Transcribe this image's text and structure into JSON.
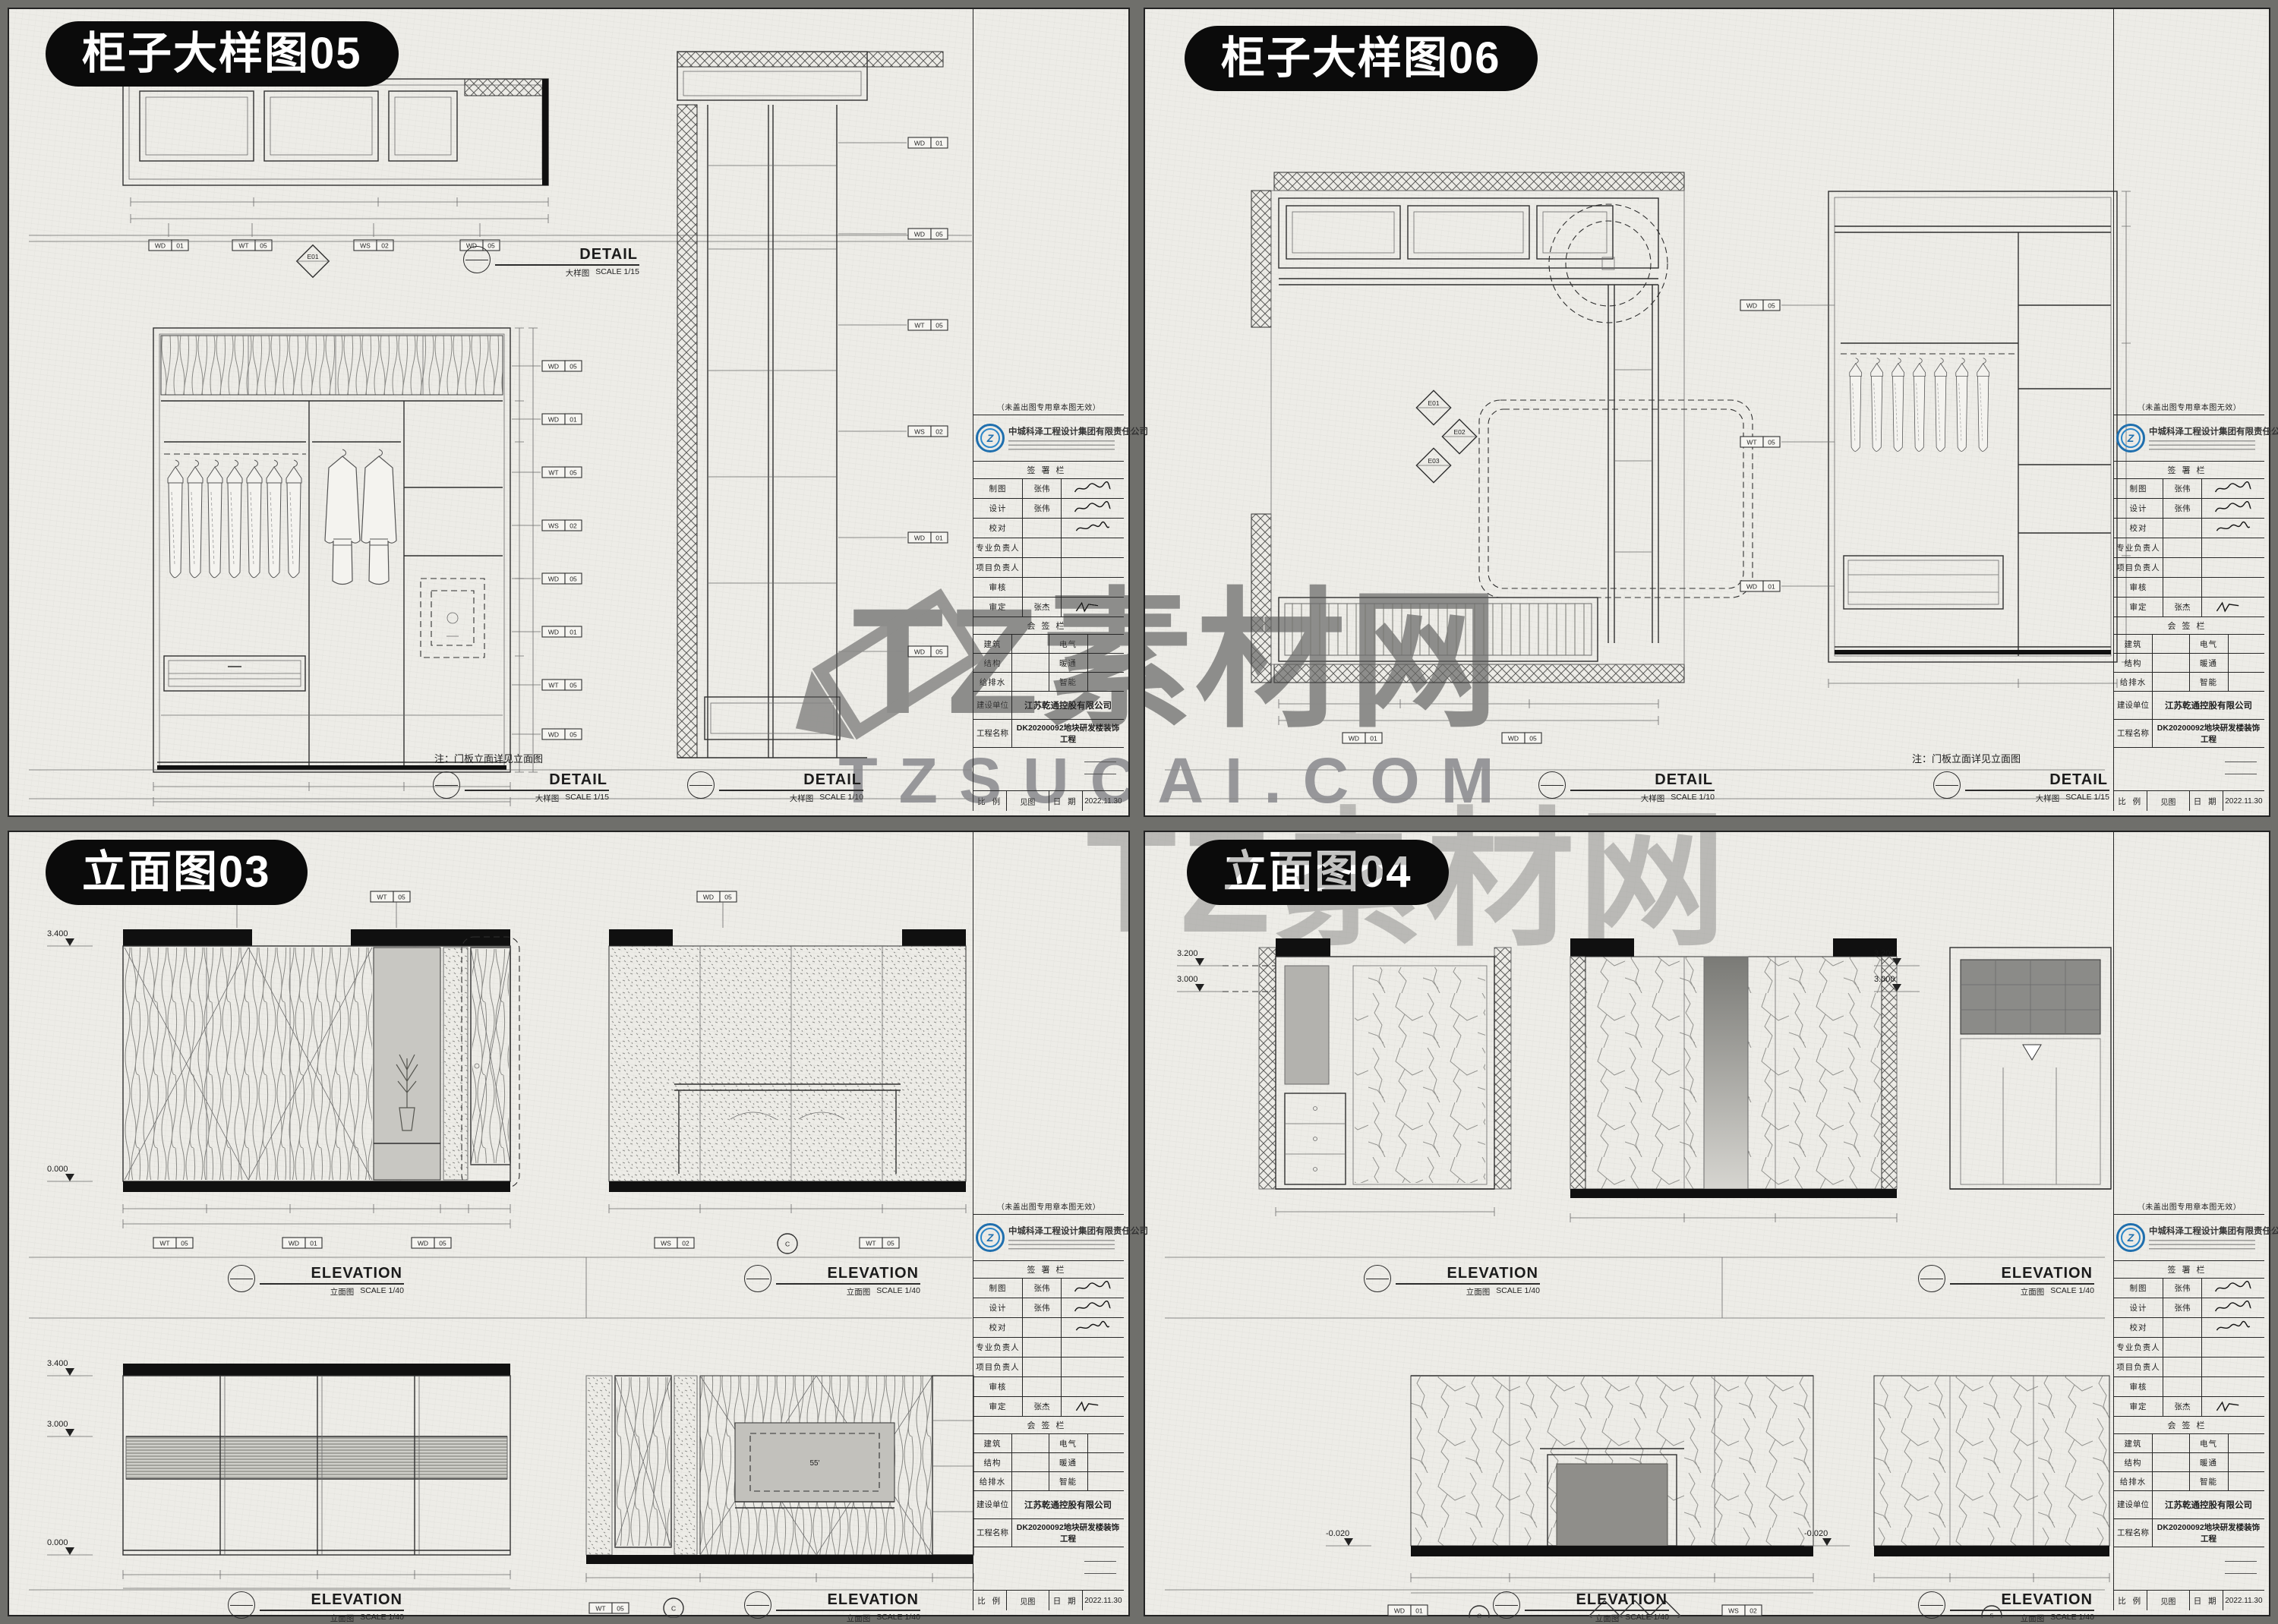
{
  "watermark": {
    "brand": "TZ素材网",
    "domain": "TZSUCAI.COM"
  },
  "labels": {
    "detail": "DETAIL",
    "elevation": "ELEVATION",
    "detail_cn": "大样图",
    "elevation_cn": "立面图",
    "scale_1_15": "SCALE 1/15",
    "scale_1_10": "SCALE 1/10",
    "scale_1_40": "SCALE 1/40"
  },
  "notes": {
    "door_panel": "注：门板立面详见立面图"
  },
  "sheets": {
    "tl": {
      "title": "柜子大样图05"
    },
    "tr": {
      "title": "柜子大样图06"
    },
    "bl": {
      "title": "立面图03"
    },
    "br": {
      "title": "立面图04"
    }
  },
  "titleblock": {
    "stamp_note": "（未盖出图专用章本图无效）",
    "company": "中城科泽工程设计集团有限责任公司",
    "sign_header": "签署栏",
    "rows": [
      {
        "label": "制图",
        "name": "张伟"
      },
      {
        "label": "设计",
        "name": "张伟"
      },
      {
        "label": "校对",
        "name": ""
      },
      {
        "label": "专业负责人",
        "name": ""
      },
      {
        "label": "项目负责人",
        "name": ""
      },
      {
        "label": "审核",
        "name": ""
      },
      {
        "label": "审定",
        "name": "张杰"
      }
    ],
    "countersign_header": "会签栏",
    "disciplines": [
      [
        "建筑",
        "电气"
      ],
      [
        "结构",
        "暖通"
      ],
      [
        "给排水",
        "智能"
      ]
    ],
    "client_label": "建设单位",
    "client": "江苏乾通控股有限公司",
    "project_label": "工程名称",
    "project": "DK20200092地块研发楼装饰工程",
    "scale_label": "比 例",
    "scale_value": "见图",
    "date_label": "日 期",
    "date_value": "2022.11.30"
  },
  "levels": {
    "l3400": "3.400",
    "l3200": "3.200",
    "l3000": "3.000",
    "l0": "0.000",
    "lm020": "-0.020"
  },
  "symbols": {
    "e01": "E01",
    "e02": "E02",
    "e03": "E03",
    "grid_c": "C",
    "grid_5": "5",
    "tv": "55'"
  },
  "tags": {
    "wd01": [
      "WD",
      "01"
    ],
    "wd05": [
      "WD",
      "05"
    ],
    "wt05": [
      "WT",
      "05"
    ],
    "ws02": [
      "WS",
      "02"
    ]
  }
}
